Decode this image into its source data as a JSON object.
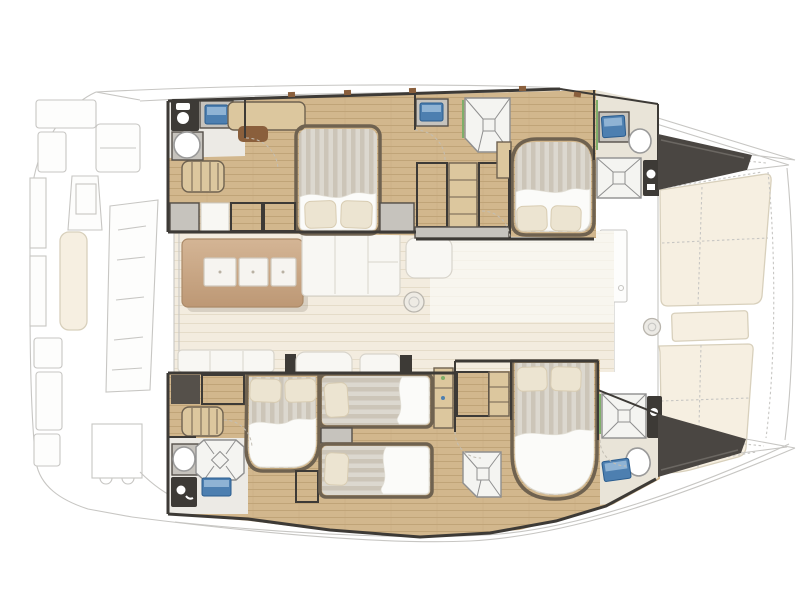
{
  "page": {
    "title": "Catamaran yacht deck plan - top view, bow right: twin hulls with four double cabins, two single berths, four heads with showers, central saloon with galley island, ghosted aft cockpit and foredeck sunpads",
    "background": "#ffffff"
  },
  "palette": {
    "ghost_line": "#c7c6c3",
    "ghost_fill": "#fdfdfc",
    "wall_dark": "#3d3a36",
    "wall_mid": "#55504a",
    "forepeak": "#4a4642",
    "wood_floor": "#d2b78d",
    "wood_line": "#c0a478",
    "saloon_floor": "#f3ecdf",
    "saloon_line": "#e5dcc9",
    "bath_floor": "#eceae5",
    "bath_floor_warm": "#e9e4d8",
    "island_light": "#d4b595",
    "island_dark": "#bd9875",
    "island_edge": "#ab8a68",
    "bed_frame": "#6f6250",
    "bed_stripe_a": "#dcd8cf",
    "bed_stripe_b": "#ccc5b8",
    "sheet_white": "#fbfbf9",
    "pillow": "#ece4d1",
    "pillow_line": "#d8ccb2",
    "sofa_white": "#f8f7f3",
    "sofa_line": "#d8d4cb",
    "sunpad": "#f6efe1",
    "sunpad_line": "#d8d0bc",
    "locker_fill": "#b7b1a6",
    "cabinet_gray": "#c6c3bd",
    "cabinet_tan": "#dcc79e",
    "sink_blue": "#4d7fb0",
    "sink_blue_light": "#8fb3d4",
    "sink_blue_dark": "#2a5c8e",
    "shower_fill": "#f4f4f1",
    "shower_line": "#8f8f8f",
    "accent_green": "#7fae6a",
    "accent_brown": "#8a5f3c"
  },
  "vessel": {
    "orientation": "bow-right",
    "aft_cockpit": {
      "style": "ghost",
      "features": [
        "transom-steps",
        "helm-station-with-screen",
        "cockpit-bench-cushion",
        "long-cockpit-table",
        "dining-table-outline",
        "bench-arc"
      ]
    },
    "foredeck": {
      "style": "ghost",
      "features": [
        "port-sunpad",
        "center-step-pad",
        "starboard-sunpad",
        "winch",
        "foredeck-door",
        "grid-mat",
        "forward-settee",
        "trampoline-lacing",
        "bow-points"
      ]
    },
    "port_hull": {
      "rooms": [
        {
          "name": "aft-head",
          "fixtures": [
            "toilet",
            "vanity-sink",
            "washbasin"
          ]
        },
        {
          "name": "aft-cabin",
          "bed": "double",
          "fixtures": [
            "steps",
            "desk",
            "desk-chair",
            "wardrobes",
            "hanging-lockers"
          ]
        },
        {
          "name": "midship-lockers",
          "fixtures": [
            "hanging-locker",
            "shelf-unit",
            "hanging-locker",
            "vanity-sink",
            "shower"
          ]
        },
        {
          "name": "forward-cabin",
          "bed": "double",
          "fixtures": [
            "side-shelf"
          ]
        },
        {
          "name": "forward-head",
          "fixtures": [
            "vanity-sink",
            "washbasin",
            "shower",
            "toilet"
          ]
        },
        {
          "name": "forepeak-locker"
        }
      ]
    },
    "starboard_hull": {
      "rooms": [
        {
          "name": "aft-cabin",
          "bed": "double",
          "fixtures": [
            "dark-cabinet",
            "hanging-locker",
            "steps"
          ]
        },
        {
          "name": "aft-head",
          "fixtures": [
            "washbasin",
            "octagon-shower",
            "toilet",
            "vanity-sink"
          ]
        },
        {
          "name": "midship-cabin",
          "beds": [
            "single",
            "single"
          ],
          "fixtures": [
            "nightstand",
            "ladder-locker",
            "shelf-column",
            "hanging-locker",
            "shelf-unit"
          ]
        },
        {
          "name": "forward-cabin",
          "bed": "double",
          "fixtures": [
            "shower"
          ]
        },
        {
          "name": "forward-head",
          "fixtures": [
            "shower",
            "toilet",
            "washbasin",
            "vanity-sink"
          ]
        },
        {
          "name": "forepeak-locker"
        }
      ]
    },
    "saloon": {
      "features": [
        "galley-island",
        "sink-module-1",
        "sink-module-2",
        "sink-module-3",
        "l-sofa",
        "chaise-daybed",
        "floor-hatch",
        "aft-bench",
        "companionway-seat",
        "side-seat"
      ]
    }
  }
}
